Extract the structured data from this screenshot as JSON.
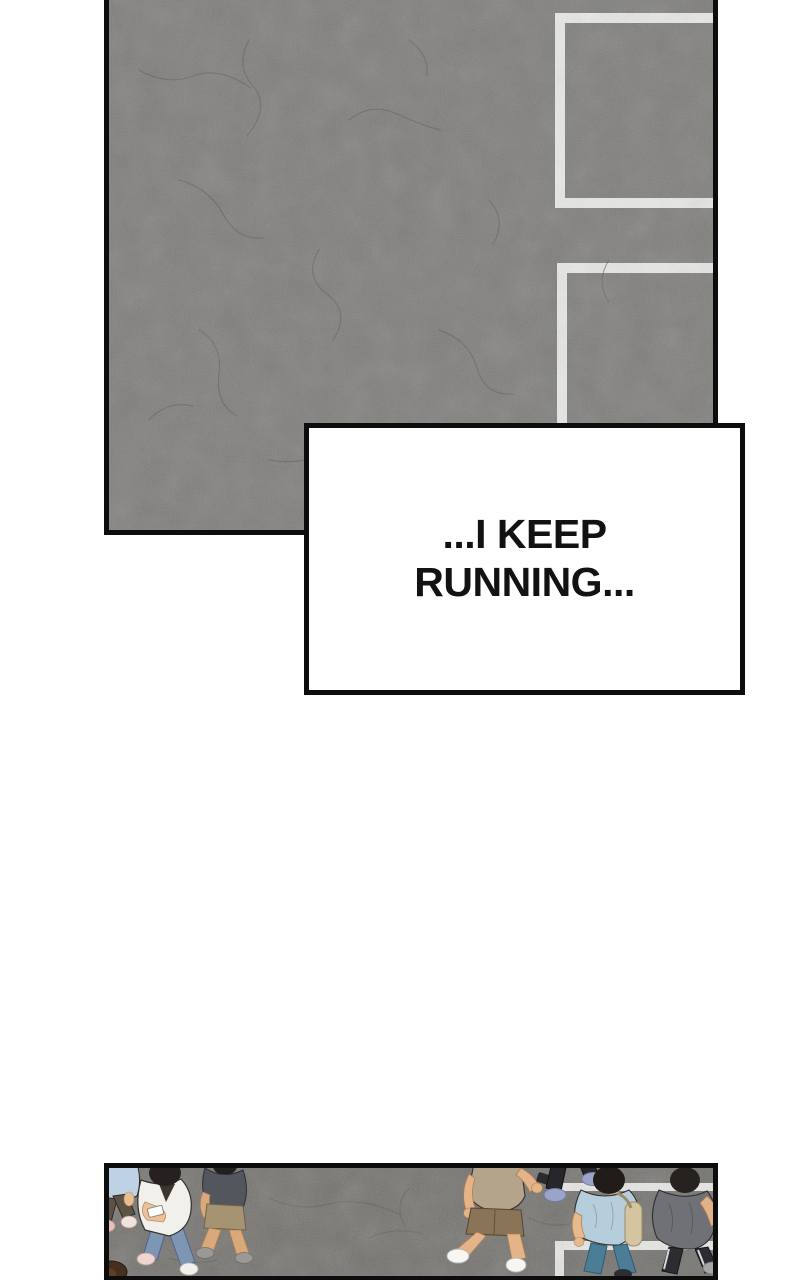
{
  "caption": {
    "lines": [
      "...I KEEP",
      "RUNNING..."
    ]
  },
  "colors": {
    "page_bg": "#ffffff",
    "panel_border": "#0d0d0d",
    "asphalt_top": "#7c7b78",
    "asphalt_bottom": "#716f6b",
    "road_line": "#ebecea",
    "crack_line": "#55544f",
    "caption_bg": "#ffffff",
    "caption_border": "#0d0d0d",
    "caption_text": "#121212"
  }
}
